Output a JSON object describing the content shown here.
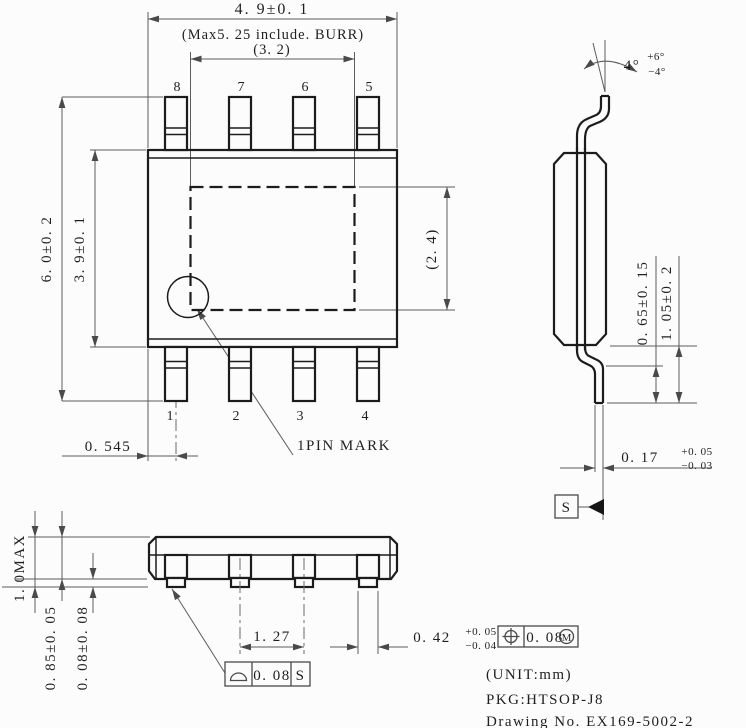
{
  "drawing": {
    "colors": {
      "background": "#fcfcfc",
      "outline": "#1c1c1c",
      "dimension_lines": "#5c5c5c",
      "text": "#1f1f1f"
    },
    "top_view": {
      "dim_overall_width": "4. 9±0. 1",
      "dim_burr_note": "(Max5. 25 include. BURR)",
      "dim_pad_width": "(3. 2)",
      "dim_overall_height": "6. 0±0. 2",
      "dim_body_height": "3. 9±0. 1",
      "dim_pad_height": "(2. 4)",
      "dim_pin1_offset": "0. 545",
      "pin_mark_label": "1PIN MARK",
      "pins_top": [
        "8",
        "7",
        "6",
        "5"
      ],
      "pins_bottom": [
        "1",
        "2",
        "3",
        "4"
      ]
    },
    "side_view": {
      "lead_angle": "4°",
      "lead_angle_plus": "+6°",
      "lead_angle_minus": "−4°",
      "dim_lead_flat": "0. 65±0. 15",
      "dim_lead_height": "1. 05±0. 2",
      "dim_lead_thickness": "0. 17",
      "dim_lead_thickness_plus": "+0. 05",
      "dim_lead_thickness_minus": "−0. 03",
      "datum_label": "S"
    },
    "front_view": {
      "dim_total_height": "1. 0MAX",
      "dim_body_thickness": "0. 85±0. 05",
      "dim_standoff": "0. 08±0. 08",
      "dim_lead_pitch": "1. 27",
      "dim_lead_width": "0. 42",
      "dim_lead_width_plus": "+0. 05",
      "dim_lead_width_minus": "−0. 04",
      "position_tolerance": "0. 08",
      "position_modifier": "M",
      "seating_tolerance": "0. 08",
      "seating_datum": "S"
    },
    "notes": {
      "unit_note": "(UNIT:mm)",
      "package_label": "PKG:HTSOP-J8",
      "drawing_number": "Drawing No. EX169-5002-2"
    }
  }
}
